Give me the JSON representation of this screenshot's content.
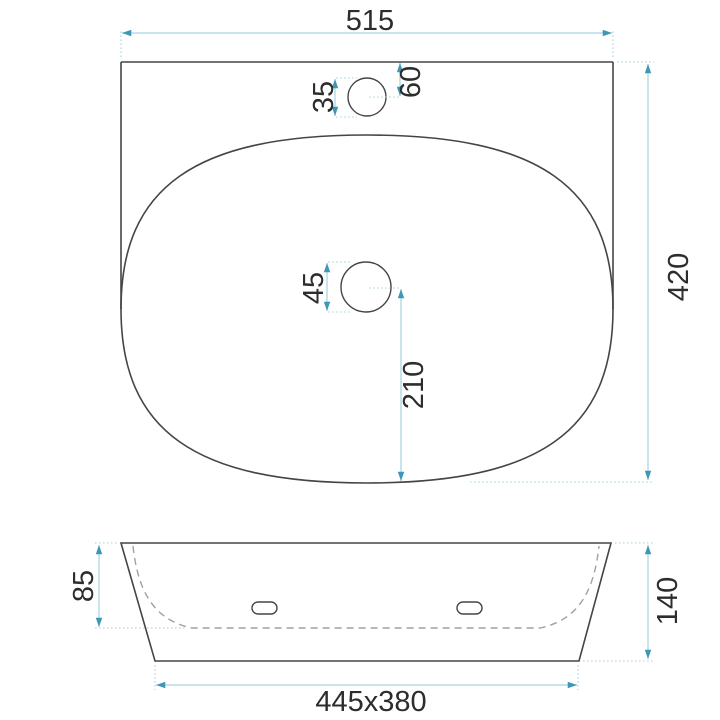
{
  "colors": {
    "outline": "#454545",
    "hidden_line": "#a0a0a0",
    "dimension_line": "#a7d3e1",
    "arrow": "#3f97b8",
    "text": "#2d2d2d",
    "background": "#ffffff"
  },
  "top_view": {
    "overall_width": "515",
    "overall_depth": "420",
    "faucet_hole_diameter": "35",
    "faucet_hole_offset_from_back": "60",
    "drain_hole_diameter": "45",
    "drain_to_front_distance": "210"
  },
  "front_view": {
    "basin_inner_depth": "85",
    "total_height": "140",
    "base_dimensions": "445x380"
  }
}
